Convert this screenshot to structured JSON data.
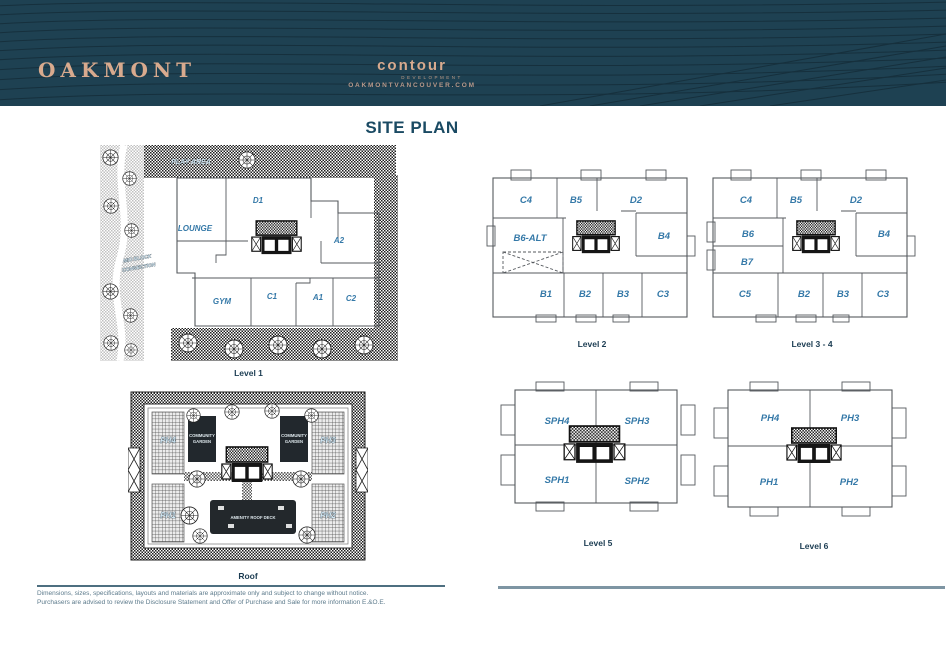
{
  "header": {
    "brand": "OAKMONT",
    "developer_logo": "contour",
    "developer_sub": "DEVELOPMENT",
    "website": "OAKMONTVANCOUVER.COM"
  },
  "title": "SITE PLAN",
  "colors": {
    "header_bg": "#1e4152",
    "brand_tan": "#d8aa8e",
    "unit_label_blue": "#3579a8",
    "caption_navy": "#1b3c52"
  },
  "plans": {
    "level1": {
      "caption": "Level 1",
      "units": [
        "LOUNGE",
        "D1",
        "A2",
        "GYM",
        "C1",
        "A1",
        "C2"
      ],
      "labels": {
        "play_area": "PLAY AREA",
        "mid_block_line1": "MID BLOCK",
        "mid_block_line2": "CONNECTION"
      }
    },
    "level2": {
      "caption": "Level 2",
      "units": [
        "C4",
        "B5",
        "D2",
        "B6-ALT",
        "B4",
        "B1",
        "B2",
        "B3",
        "C3"
      ]
    },
    "level34": {
      "caption": "Level 3 - 4",
      "units": [
        "C4",
        "B5",
        "D2",
        "B6",
        "B4",
        "B7",
        "C5",
        "B2",
        "B3",
        "C3"
      ]
    },
    "level5": {
      "caption": "Level 5",
      "units": [
        "SPH4",
        "SPH3",
        "SPH1",
        "SPH2"
      ]
    },
    "level6": {
      "caption": "Level 6",
      "units": [
        "PH4",
        "PH3",
        "PH1",
        "PH2"
      ]
    },
    "roof": {
      "caption": "Roof",
      "units": [
        "PH4",
        "PH3",
        "PH1",
        "PH2"
      ],
      "labels": {
        "garden_line1": "COMMUNITY",
        "garden_line2": "GARDEN",
        "amenity": "AMENITY ROOF DECK"
      }
    }
  },
  "footer": {
    "disclaimer_line1": "Dimensions, sizes, specifications, layouts and materials are approximate only and subject to change without notice.",
    "disclaimer_line2": "Purchasers are advised to review the Disclosure Statement and Offer of Purchase and Sale for more information E.&O.E."
  }
}
